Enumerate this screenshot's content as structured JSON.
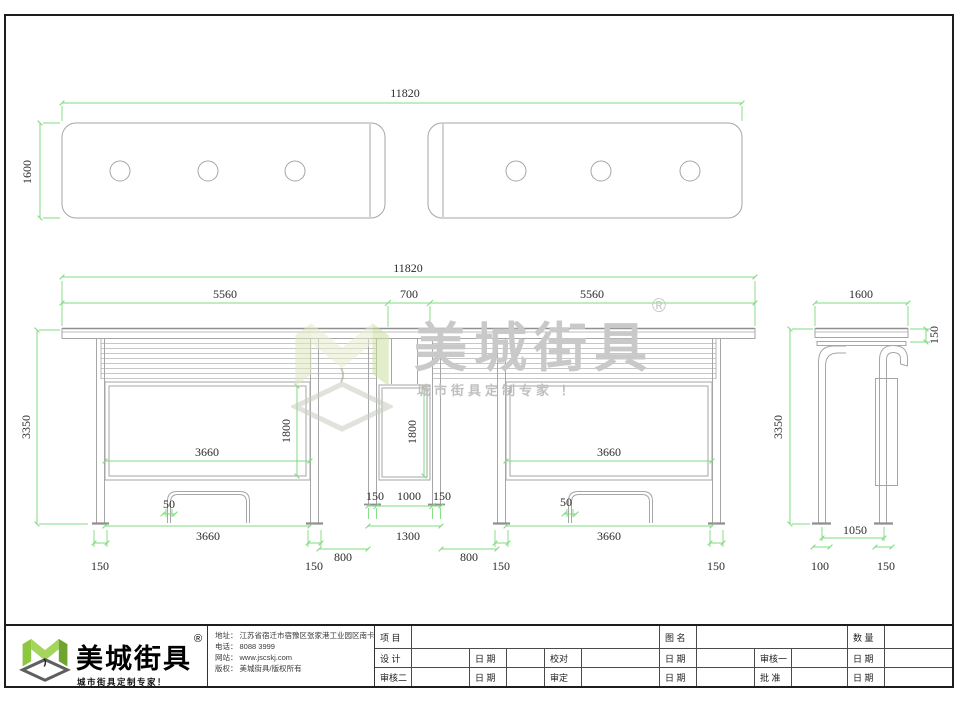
{
  "colors": {
    "dimension_green": "#7fdb7f",
    "line_gray": "#a6a6a6",
    "brand_green": "#8dc63f",
    "watermark_gray": "#c9c9c9"
  },
  "dims": {
    "w11820": "11820",
    "w5560": "5560",
    "w700": "700",
    "d1600": "1600",
    "h3350": "3350",
    "w3660": "3660",
    "h1800": "1800",
    "w1000": "1000",
    "w1300": "1300",
    "w800": "800",
    "n150": "150",
    "n100": "100",
    "n50": "50",
    "n1050": "1050"
  },
  "watermark": {
    "name": "美城街具",
    "reg": "®",
    "slogan": "城市街具定制专家 ！"
  },
  "company": {
    "name": "美城街具",
    "reg": "®",
    "slogan": "城市街具定制专家！",
    "contact": {
      "address_label": "地址：",
      "address": "江苏省宿迁市宿豫区张家港工业园区南卡路南侧1号",
      "phone_label": "电话：",
      "phone": "8088 3999",
      "web_label": "网站：",
      "web": "www.jscskj.com",
      "copyright_label": "版权：",
      "copyright": "美城街具/版权所有"
    }
  },
  "titleblock": {
    "labels": {
      "project": "项 目",
      "drawing_name": "图 名",
      "quantity": "数 量",
      "design": "设 计",
      "date": "日 期",
      "proofread": "校对",
      "review1": "审核一",
      "review2": "审核二",
      "verify": "审定",
      "approve": "批 准"
    }
  }
}
